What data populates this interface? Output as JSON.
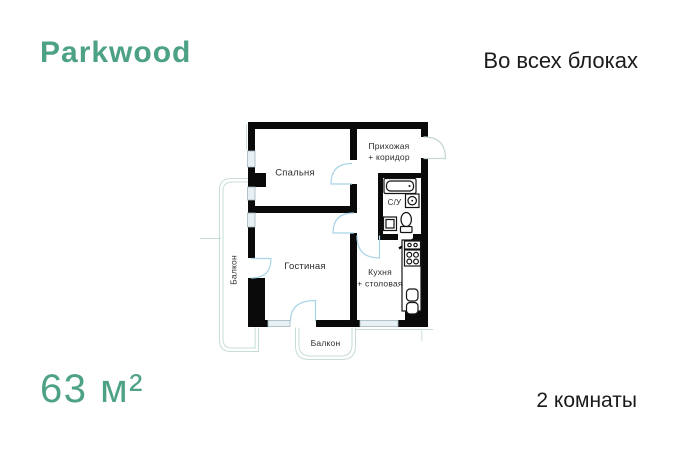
{
  "brand": {
    "name": "Parkwood"
  },
  "header": {
    "availability": "Во всех блоках"
  },
  "summary": {
    "area": "63 м²",
    "rooms": "2 комнаты"
  },
  "floorplan": {
    "labels": {
      "bedroom": "Спальня",
      "hallway_line1": "Прихожая",
      "hallway_line2": "+ коридор",
      "bathroom": "С/У",
      "living_room": "Гостиная",
      "kitchen_line1": "Кухня",
      "kitchen_line2": "+ столовая",
      "balcony_left": "Балкон",
      "balcony_bottom": "Балкон"
    }
  },
  "colors": {
    "accent": "#4DA286",
    "text": "#1b1b1b",
    "walls": "#0a0a0a",
    "door_arc": "#a8d4e6",
    "balcony_line": "#c6ddd7",
    "window_fill": "#e9f0f3"
  }
}
